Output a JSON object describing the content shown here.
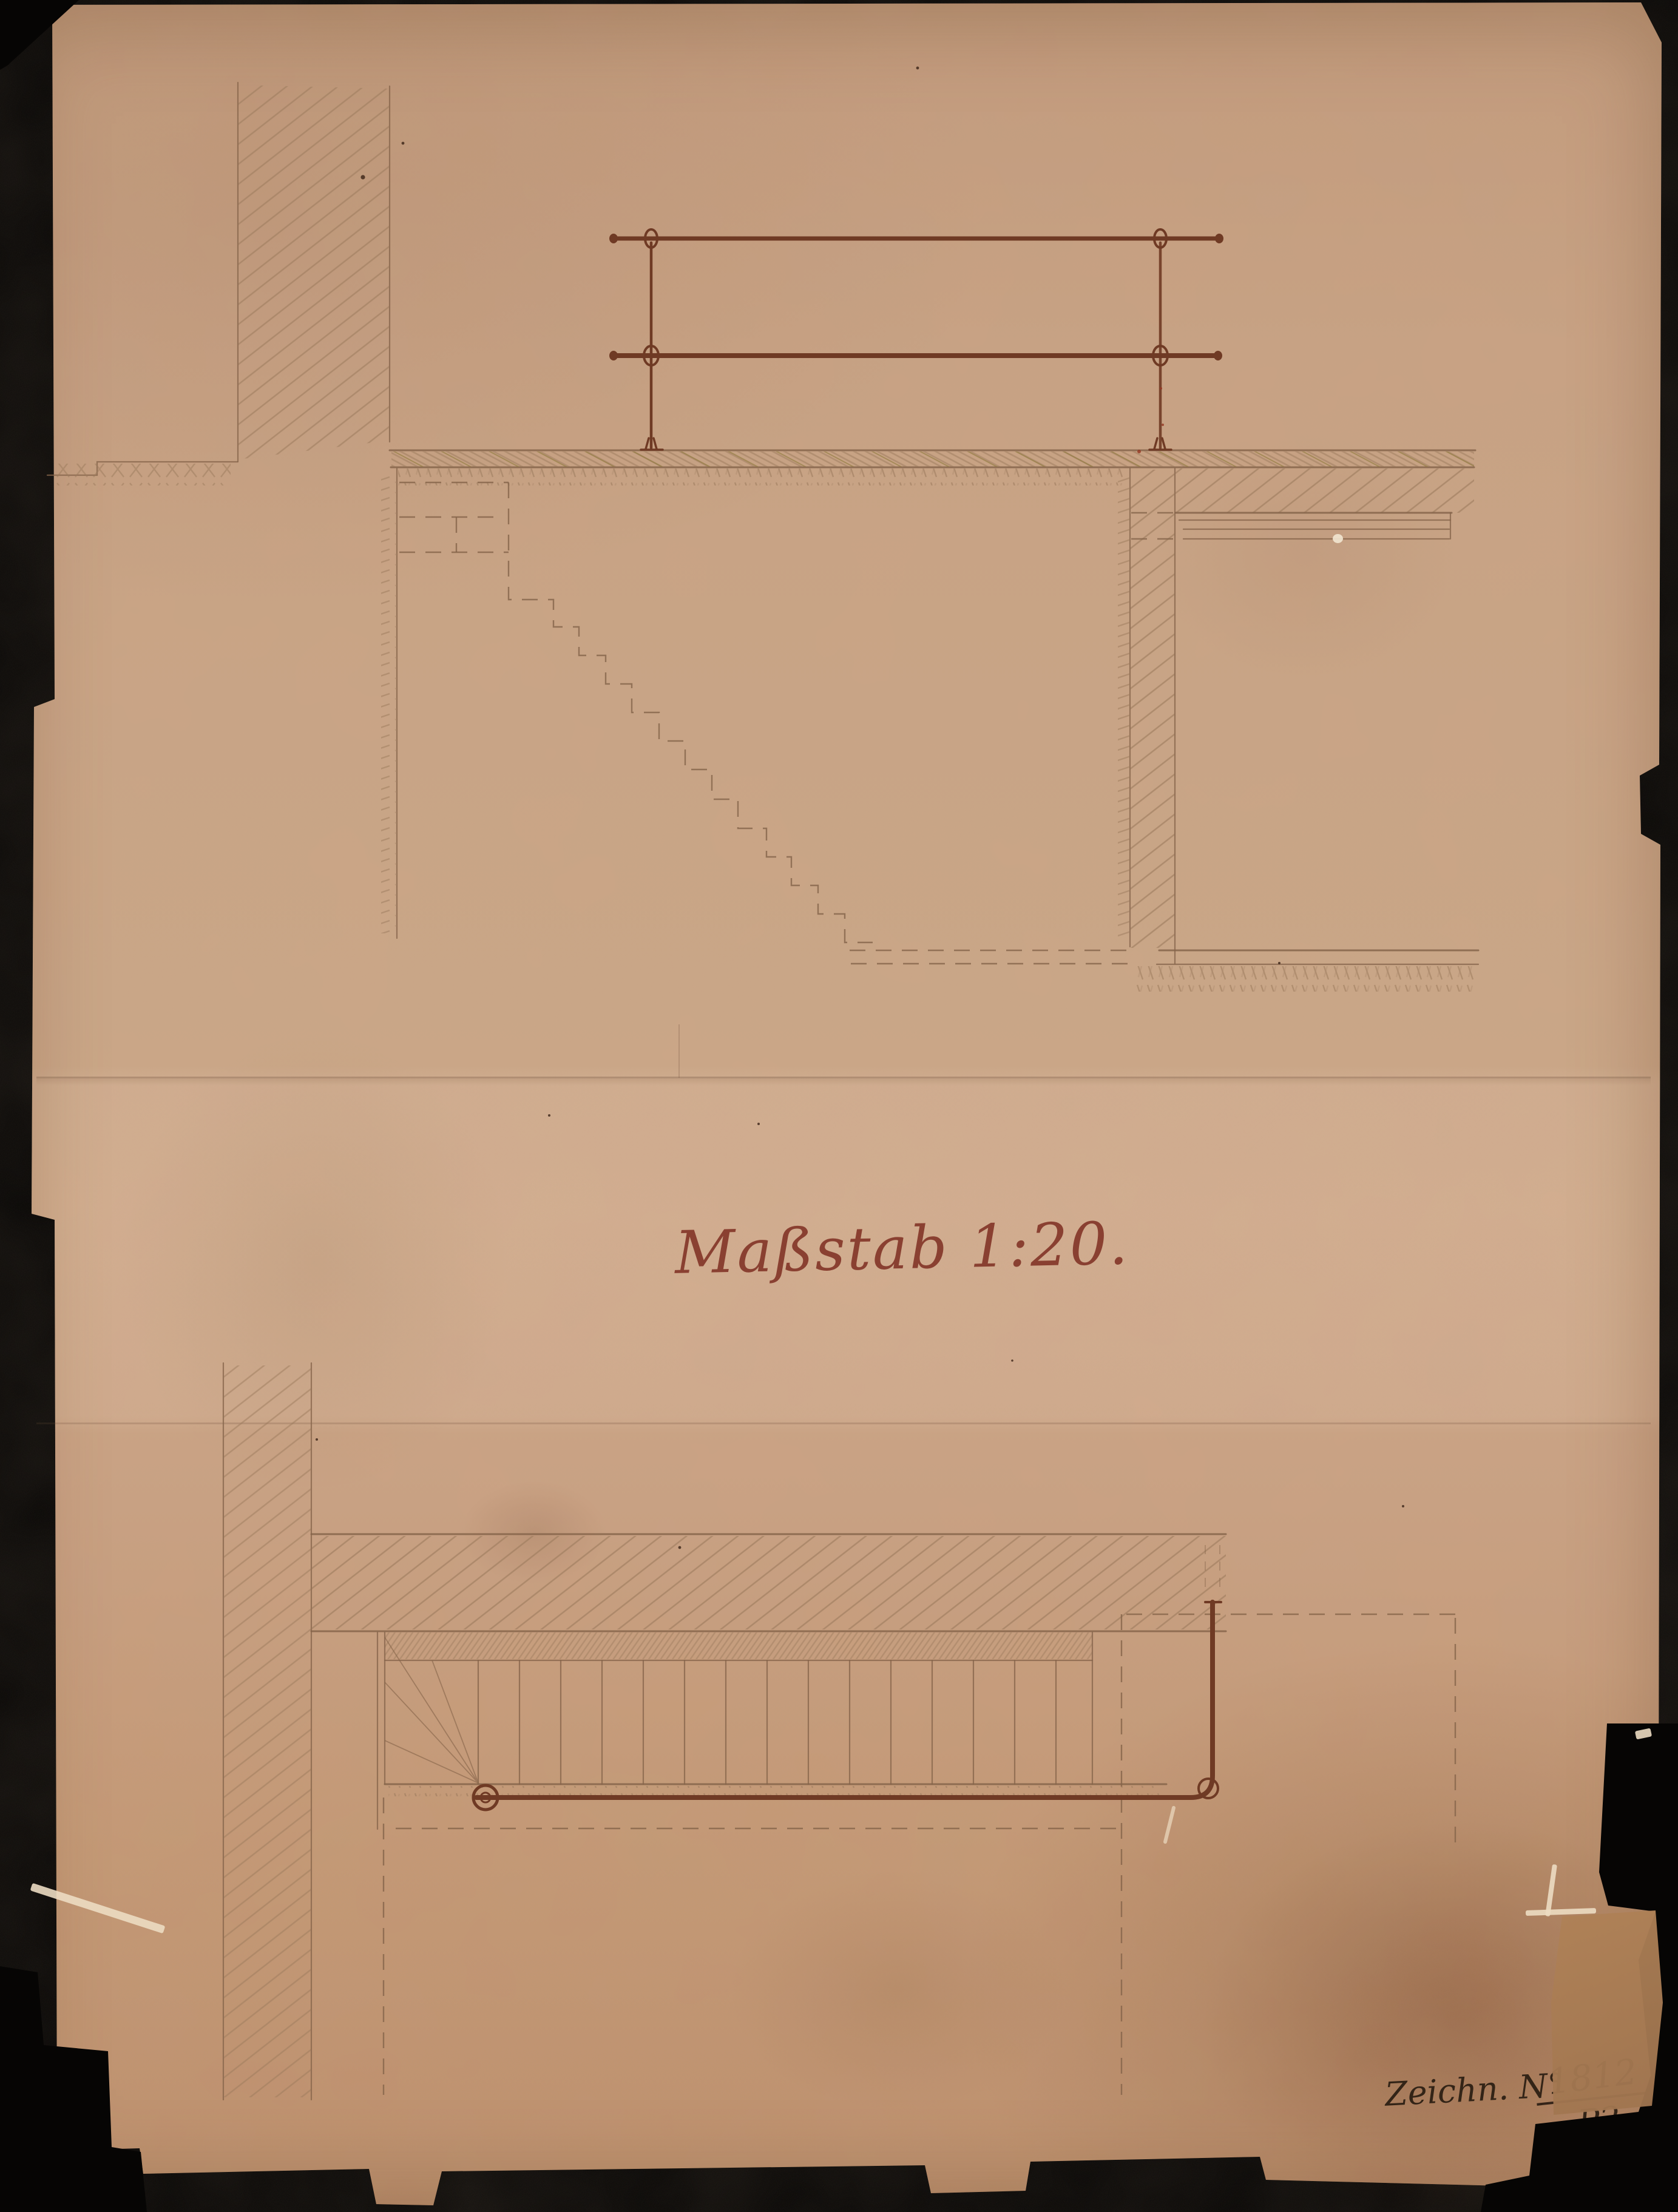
{
  "page": {
    "scale_label": "Maßstab 1:20.",
    "note": {
      "prefix": "Zeichn. N°",
      "numerator": "1812",
      "denominator": "P2"
    }
  },
  "colors": {
    "background": "#060504",
    "paper": "#c9a283",
    "paper_light": "#d6b294",
    "paper_dark": "#b68a67",
    "pencil": "#85644a",
    "hatch": "#9b7a5c",
    "ink_rail": "#6f3a24",
    "ink_red": "#943722",
    "title_ink": "#84372a",
    "note_ink": "#2d2014",
    "tear_highlight": "#ecdcc2",
    "flap": "#aa7f5c"
  }
}
